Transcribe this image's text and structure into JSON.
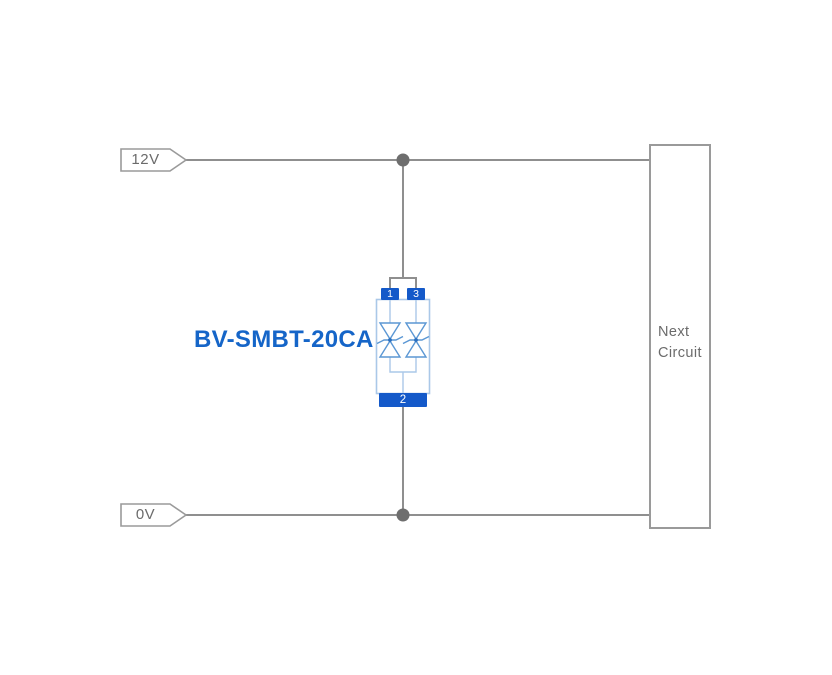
{
  "colors": {
    "background": "#ffffff",
    "wire": "#8f8f8f",
    "junction": "#6e6e6e",
    "outline": "#9a9a9a",
    "gray_text": "#6b6b6b",
    "pad_blue": "#1459c9",
    "body_blue": "#aac8e8",
    "diode_blue": "#5b97d4",
    "diode_dot": "#2a6fc0",
    "label_blue": "#1565c8"
  },
  "rails": {
    "top_label": "12V",
    "bottom_label": "0V"
  },
  "component": {
    "part_number": "BV-SMBT-20CA",
    "pin_top_left": "1",
    "pin_top_right": "3",
    "pin_bottom": "2"
  },
  "next_circuit": {
    "line1": "Next",
    "line2": "Circuit"
  }
}
